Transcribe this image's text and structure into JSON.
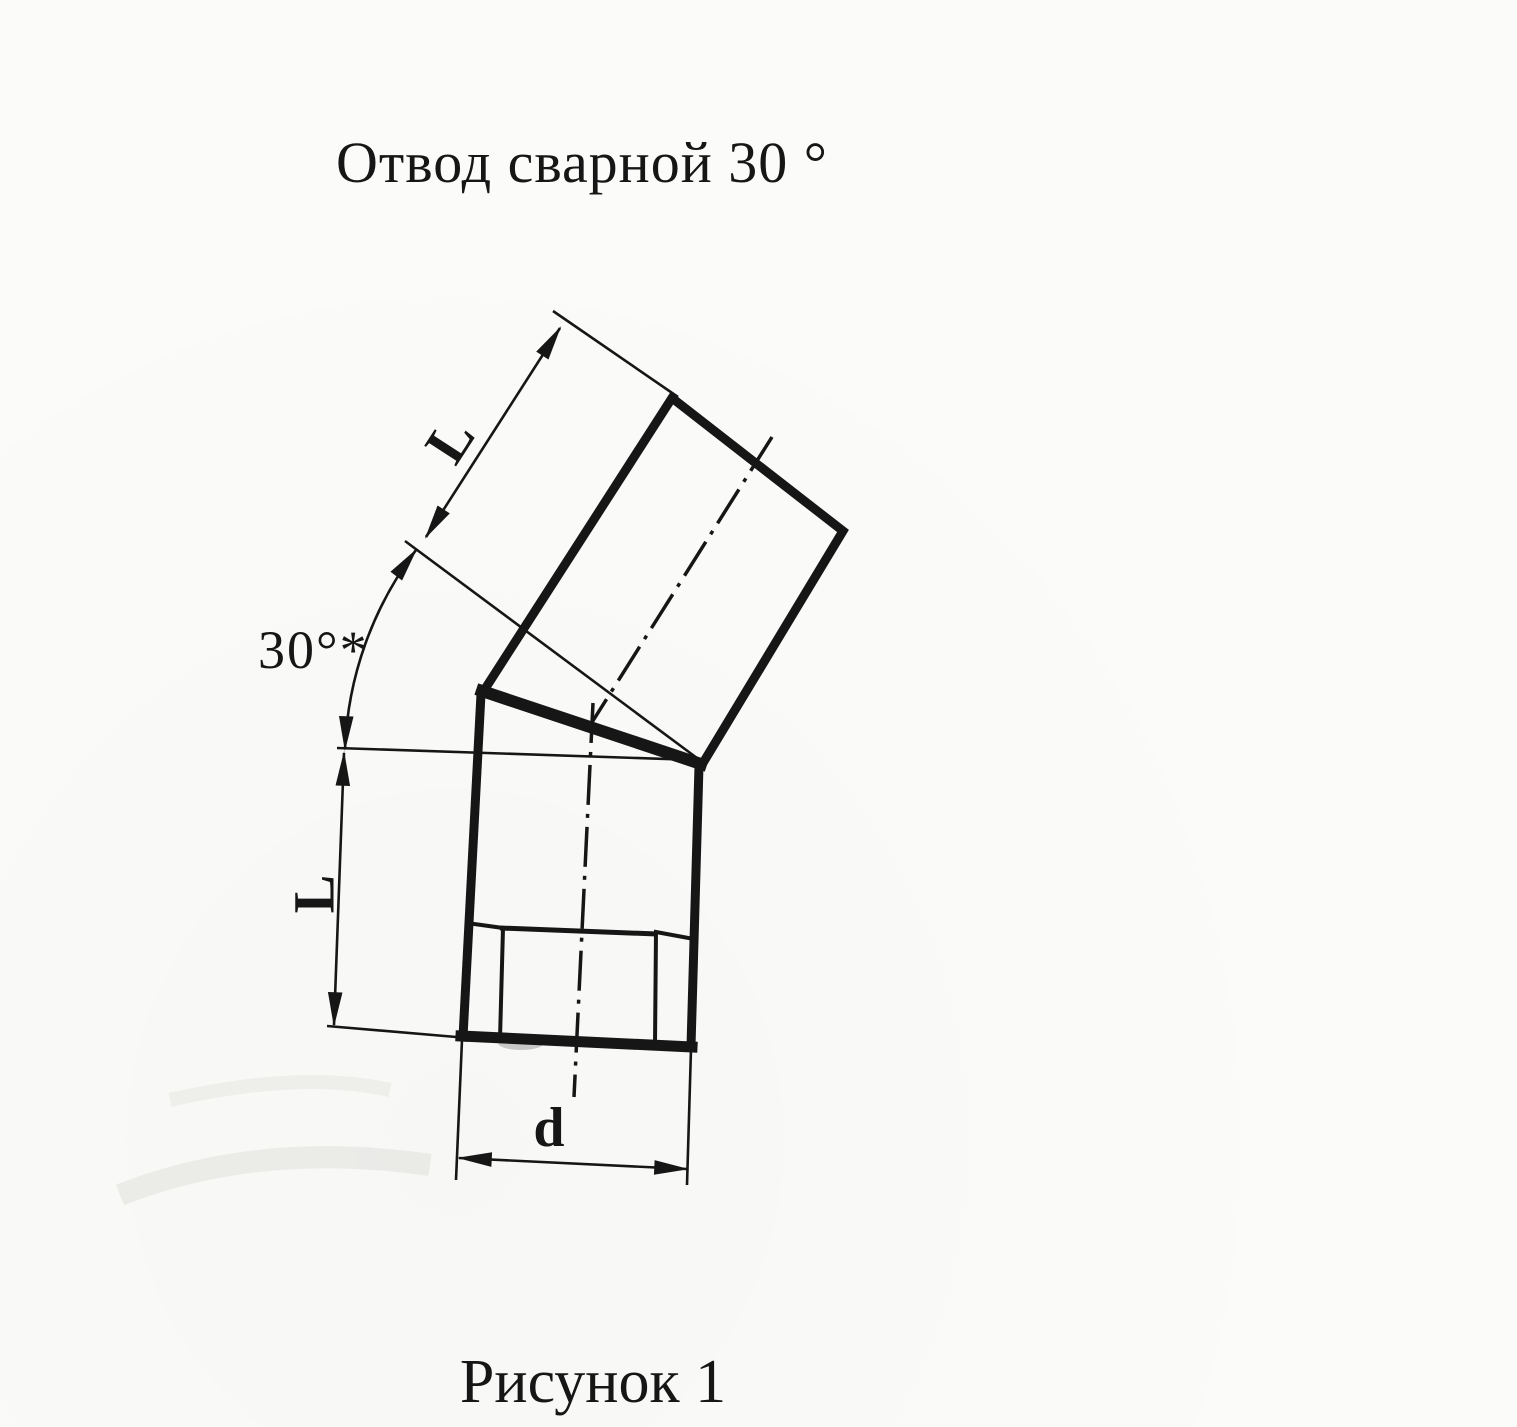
{
  "document": {
    "title": "Отвод сварной  30 °",
    "caption": "Рисунок 1"
  },
  "drawing": {
    "labels": {
      "upper_length": "L",
      "angle": "30°*",
      "lower_length": "L",
      "diameter": "d"
    }
  },
  "colors": {
    "ink": "#161616",
    "paper": "#fbfbf9"
  }
}
